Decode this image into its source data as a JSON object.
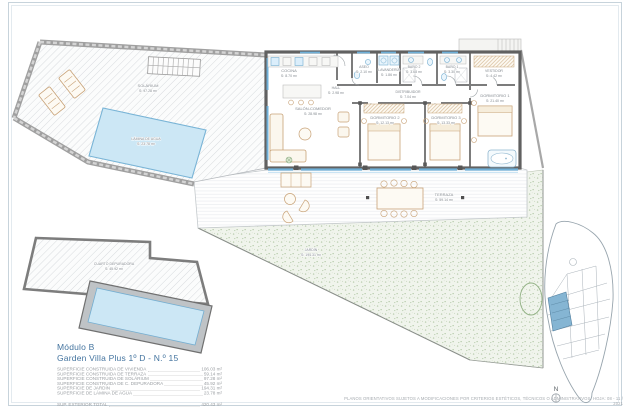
{
  "document": {
    "module": "Módulo B",
    "unit": "Garden Villa Plus 1º D - N.º 15",
    "north_label": "N",
    "disclaimer": "PLANOS ORIENTATIVOS SUJETOS A MODIFICACIONES POR CRITERIOS ESTÉTICOS, TÉCNICOS O ADMINISTRATIVOS. HOJA: 08 - 11 / 2021"
  },
  "areas": {
    "rows": [
      {
        "label": "SUPERFICIE CONSTRUIDA DE VIVIENDA",
        "value": "106.03 m²"
      },
      {
        "label": "SUPERFICIE CONSTRUIDA DE TERRAZA",
        "value": "59.14 m²"
      },
      {
        "label": "SUPERFICIE CONSTRUIDA DE SOLÁRIUM",
        "value": "97.28 m²"
      },
      {
        "label": "SUPERFICIE CONSTRUIDA DE C. DEPURADORA",
        "value": "45.92 m²"
      },
      {
        "label": "SUPERFICIE DE JARDÍN",
        "value": "194.31 m²"
      },
      {
        "label": "SUPERFICIE DE LÁMINA DE AGUA",
        "value": "23.78 m²"
      }
    ],
    "total": {
      "label": "SUP. EXTERIOR TOTAL",
      "value": "420.43 m²"
    }
  },
  "rooms": {
    "cocina": {
      "name": "COCINA",
      "area": "S: 8.70 m²"
    },
    "hall": {
      "name": "HALL",
      "area": "S: 2.98 m²"
    },
    "aseo": {
      "name": "ASEO",
      "area": "S: 2.10 m²"
    },
    "lavanderia": {
      "name": "LAVANDERÍA",
      "area": "S: 1.86 m²"
    },
    "bano2": {
      "name": "BAÑO 2",
      "area": "S: 3.68 m²"
    },
    "bano1": {
      "name": "BAÑO 1",
      "area": "S: 3.30 m²"
    },
    "vestidor": {
      "name": "VESTIDOR",
      "area": "S: 4.42 m²"
    },
    "distribuidor": {
      "name": "DISTRIBUIDOR",
      "area": "S: 7.04 m²"
    },
    "salon": {
      "name": "SALÓN-COMEDOR",
      "area": "S: 28.98 m²"
    },
    "dormitorio2": {
      "name": "DORMITORIO 2",
      "area": "S: 12.13 m²"
    },
    "dormitorio3": {
      "name": "DORMITORIO 3",
      "area": "S: 13.33 m²"
    },
    "dormitorio1": {
      "name": "DORMITORIO 1",
      "area": "S: 21.40 m²"
    },
    "terraza": {
      "name": "TERRAZA",
      "area": "S: 59.14 m²"
    },
    "solarium": {
      "name": "SOLÁRIUM",
      "area": "S: 97.28 m²"
    },
    "lamina": {
      "name": "LÁMINA DE AGUA",
      "area": "S: 23.78 m²"
    },
    "jardin": {
      "name": "JARDÍN",
      "area": "S: 194.31 m²"
    },
    "depuradora": {
      "name": "CUARTO DEPURADORA",
      "area": "S: 45.92 m²"
    }
  },
  "colors": {
    "title_blue": "#44749f",
    "wall_gray": "#6f6f6f",
    "glazing_blue": "#6fb0d8",
    "water_fill": "#cce7f5",
    "garden_green": "#eef3e9",
    "furniture_tan": "#c8a277",
    "highlight_parcel": "#85b5d3"
  }
}
